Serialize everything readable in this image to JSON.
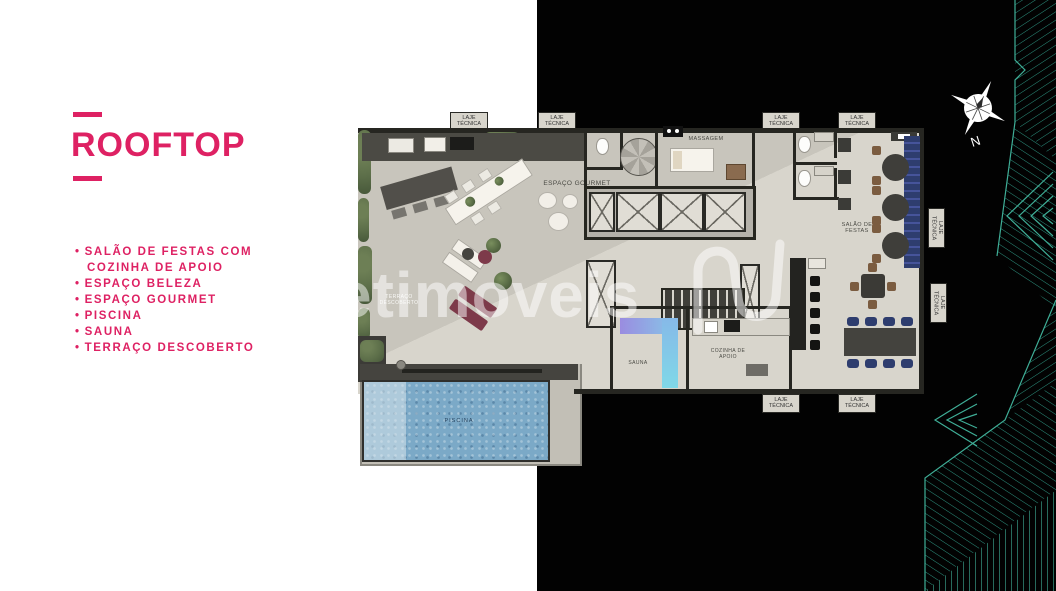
{
  "panel": {
    "title": "ROOFTOP",
    "bullet": "•",
    "features": [
      "SALÃO DE FESTAS COM COZINHA DE APOIO",
      "ESPAÇO BELEZA",
      "ESPAÇO GOURMET",
      "PISCINA",
      "SAUNA",
      "TERRAÇO DESCOBERTO"
    ]
  },
  "floorplan": {
    "labels": {
      "laje_tecnica": "LAJE TÉCNICA",
      "espaco_gourmet": "ESPAÇO GOURMET",
      "massagem": "MASSAGEM",
      "salao_de_festas": "SALÃO DE FESTAS",
      "sauna": "SAUNA",
      "cozinha_de_apoio": "COZINHA DE APOIO",
      "piscina": "PISCINA",
      "terraco_descoberto": "TERRAÇO DESCOBERTO"
    }
  },
  "watermark": {
    "text": "etimoveis"
  },
  "compass": {
    "north_label": "N"
  },
  "colors": {
    "accent": "#de2163",
    "background_left": "#ffffff",
    "background_right": "#020202",
    "wireframe_teal": "#2c917f",
    "floor_beige": "#ccc9c0",
    "wall_dark": "#262621",
    "pool_blue": "#7ba9c7",
    "navy": "#2e3d6e",
    "maroon": "#7d3a4a",
    "sauna_purple": "#9a8ce0",
    "sauna_cyan": "#7fd8e8",
    "hedge_green": "#5c6e49"
  }
}
